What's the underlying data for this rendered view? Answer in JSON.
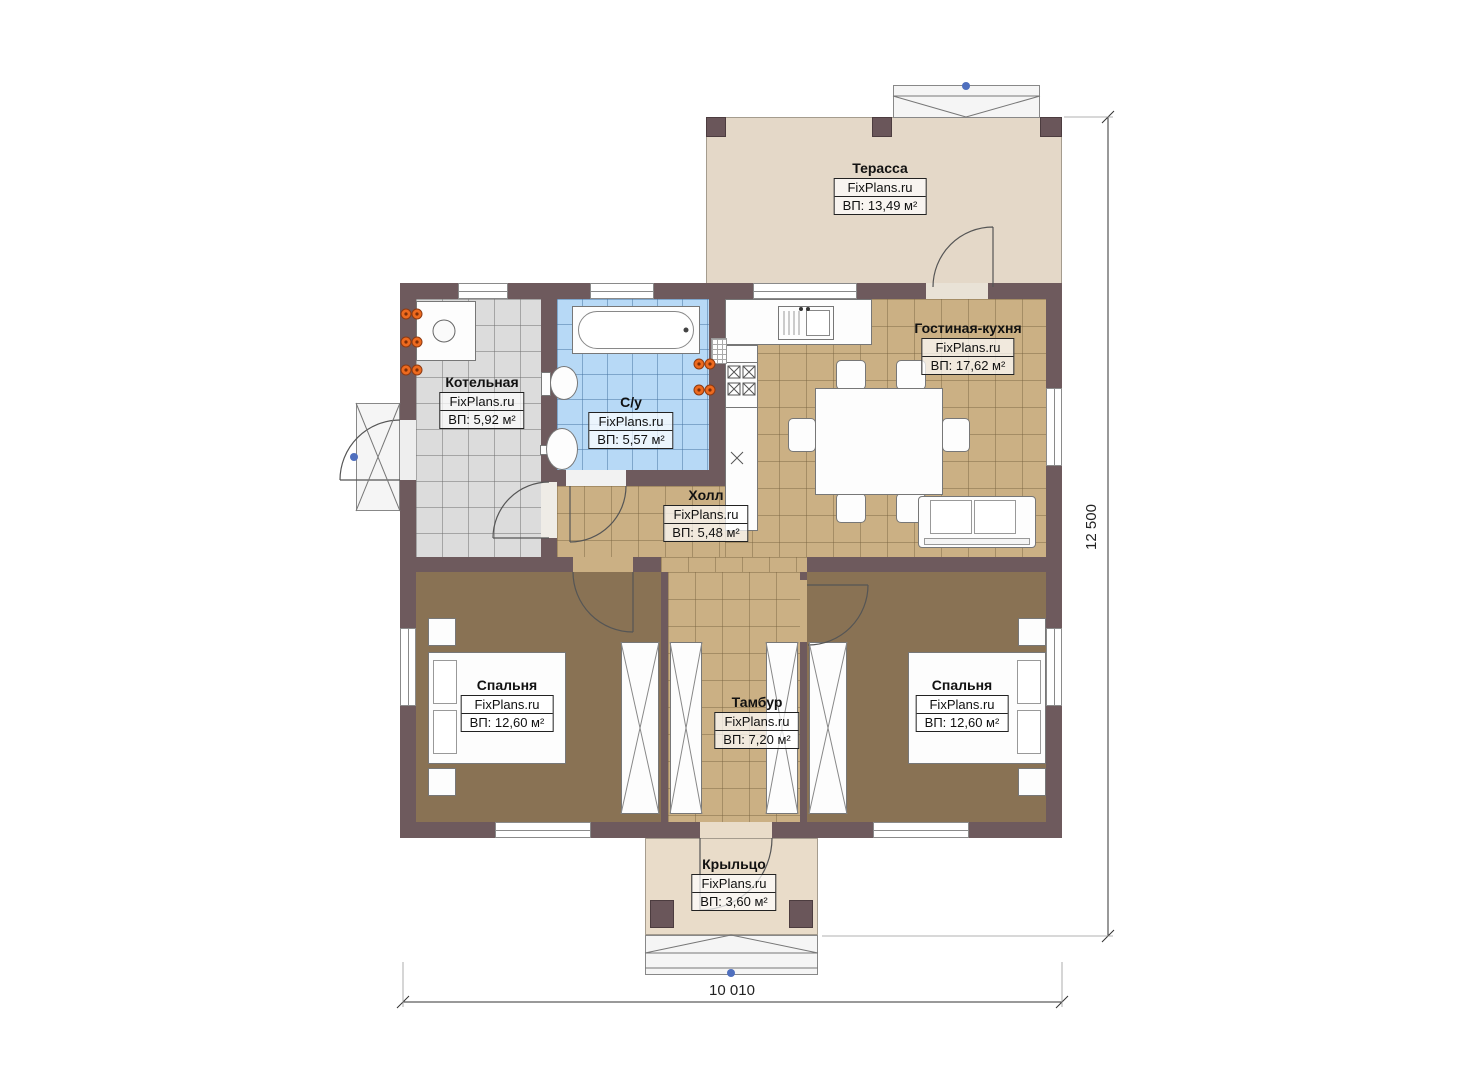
{
  "meta": {
    "source_brand": "FixPlans.ru",
    "plan_type": "floor-plan"
  },
  "dimensions": {
    "width_label": "10 010",
    "height_label": "12 500"
  },
  "colors": {
    "wall": "#6e5a5d",
    "floor_tile_tan": "#cbb084",
    "floor_tile_blue": "#b7d9f6",
    "floor_tile_gray": "#dcdcdc",
    "floor_bedroom": "#897254",
    "terrace": "#e4d8c8",
    "porch": "#e9dcc9",
    "radiator_orange": "#ed6a1f",
    "marker_blue": "#4f6fbe"
  },
  "rooms": [
    {
      "id": "terrace",
      "name": "Терасса",
      "brand": "FixPlans.ru",
      "area": "ВП: 13,49 м²"
    },
    {
      "id": "living_kitchen",
      "name": "Гостиная-кухня",
      "brand": "FixPlans.ru",
      "area": "ВП: 17,62 м²"
    },
    {
      "id": "boiler",
      "name": "Котельная",
      "brand": "FixPlans.ru",
      "area": "ВП: 5,92 м²"
    },
    {
      "id": "bathroom",
      "name": "С/у",
      "brand": "FixPlans.ru",
      "area": "ВП: 5,57 м²"
    },
    {
      "id": "hall",
      "name": "Холл",
      "brand": "FixPlans.ru",
      "area": "ВП: 5,48 м²"
    },
    {
      "id": "bedroom_left",
      "name": "Спальня",
      "brand": "FixPlans.ru",
      "area": "ВП: 12,60 м²"
    },
    {
      "id": "vestibule",
      "name": "Тамбур",
      "brand": "FixPlans.ru",
      "area": "ВП: 7,20 м²"
    },
    {
      "id": "bedroom_right",
      "name": "Спальня",
      "brand": "FixPlans.ru",
      "area": "ВП: 12,60 м²"
    },
    {
      "id": "porch",
      "name": "Крыльцо",
      "brand": "FixPlans.ru",
      "area": "ВП: 3,60 м²"
    }
  ]
}
